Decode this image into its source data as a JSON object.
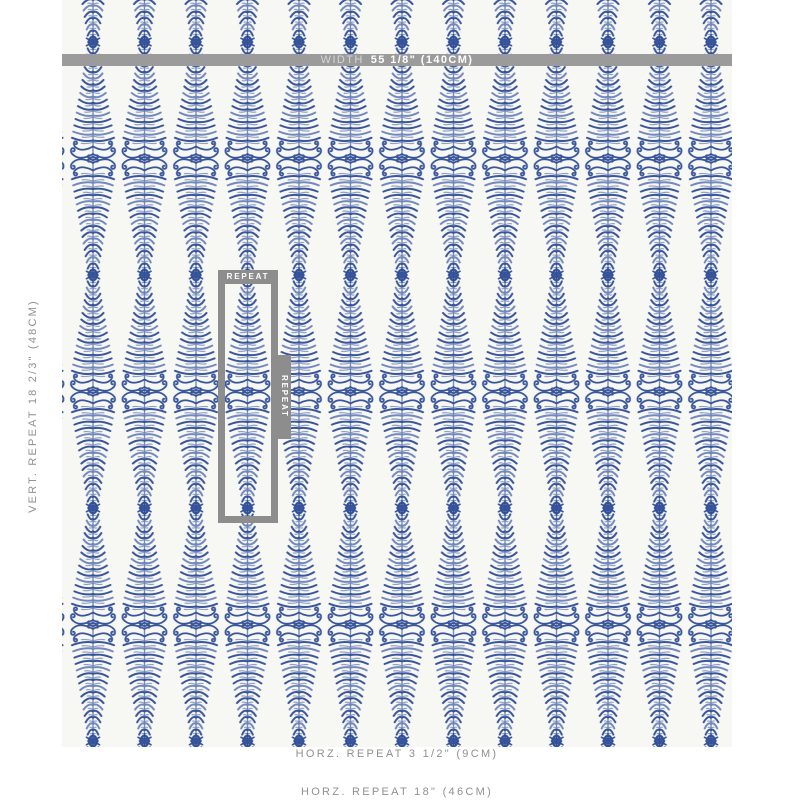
{
  "colors": {
    "page_bg": "#ffffff",
    "fabric_bg": "#f7f7f4",
    "motif_navy": "#2e4d97",
    "motif_light": "#6c83b8",
    "bar_gray": "#9b9b9b",
    "box_gray": "#8d8d8d",
    "label_gray": "#909090",
    "bar_prefix_color": "#d6d6d6",
    "bar_value_color": "#ffffff"
  },
  "fabric": {
    "columns": 13,
    "column_spacing_px": 51.5,
    "vertical_repeat_px": 233,
    "motif": "fern-stripe-lens-with-scrolls-and-palmette"
  },
  "annotations": {
    "width_bar": {
      "prefix": "WIDTH",
      "value": "55 1/8\" (140CM)"
    },
    "vert_repeat_label": "VERT. REPEAT 18 2/3\" (48CM)",
    "horz_repeat_motif_label": "HORZ. REPEAT 3 1/2\" (9CM)",
    "horz_repeat_full_label": "HORZ. REPEAT 18\" (46CM)",
    "repeat_box": {
      "top_label": "REPEAT",
      "side_label": "REPEAT"
    }
  }
}
